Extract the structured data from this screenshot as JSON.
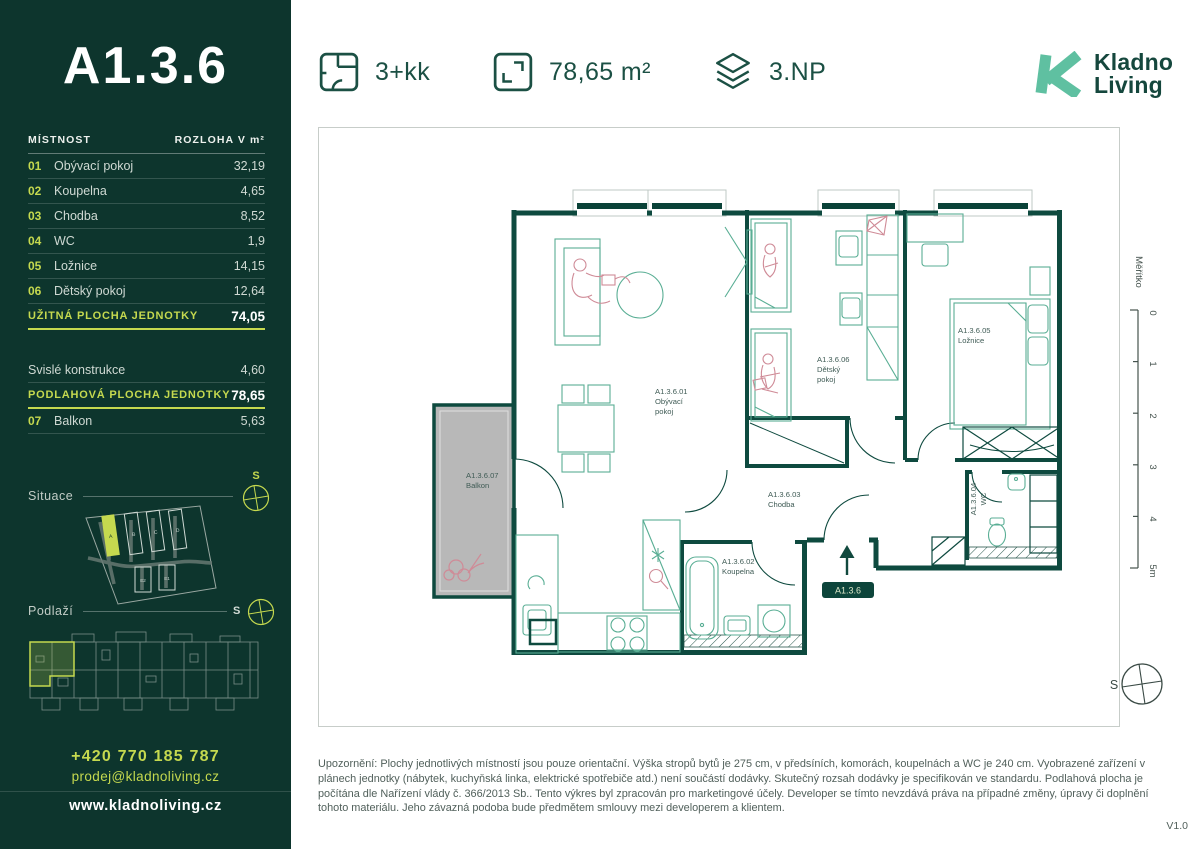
{
  "header": {
    "stats": [
      {
        "icon": "floorplan-icon",
        "value": "3+kk"
      },
      {
        "icon": "area-icon",
        "value": "78,65 m²"
      },
      {
        "icon": "floor-icon",
        "value": "3.NP"
      }
    ],
    "logo": {
      "line1": "Kladno",
      "line2": "Living"
    }
  },
  "sidebar": {
    "unit_title": "A1.3.6",
    "table_header": {
      "room": "MÍSTNOST",
      "area": "ROZLOHA V m²"
    },
    "rooms": [
      {
        "num": "01",
        "name": "Obývací pokoj",
        "area": "32,19"
      },
      {
        "num": "02",
        "name": "Koupelna",
        "area": "4,65"
      },
      {
        "num": "03",
        "name": "Chodba",
        "area": "8,52"
      },
      {
        "num": "04",
        "name": "WC",
        "area": "1,9"
      },
      {
        "num": "05",
        "name": "Ložnice",
        "area": "14,15"
      },
      {
        "num": "06",
        "name": "Dětský pokoj",
        "area": "12,64"
      }
    ],
    "usable": {
      "label": "UŽITNÁ PLOCHA JEDNOTKY",
      "value": "74,05"
    },
    "vertical": {
      "name": "Svislé konstrukce",
      "area": "4,60"
    },
    "floor_total": {
      "label": "PODLAHOVÁ PLOCHA JEDNOTKY",
      "value": "78,65"
    },
    "balcony": {
      "num": "07",
      "name": "Balkon",
      "area": "5,63"
    },
    "situace": {
      "label": "Situace",
      "compass": "S",
      "buildings": [
        "A",
        "B",
        "C",
        "D",
        "E2",
        "E1"
      ],
      "highlighted": "A"
    },
    "podlazi": {
      "label": "Podlaží",
      "compass": "S"
    },
    "contact": {
      "phone": "+420 770 185 787",
      "email": "prodej@kladnoliving.cz",
      "web": "www.kladnoliving.cz"
    }
  },
  "plan": {
    "labels": {
      "living": {
        "code": "A1.3.6.01",
        "l1": "Obývací",
        "l2": "pokoj"
      },
      "kids": {
        "code": "A1.3.6.06",
        "l1": "Dětský",
        "l2": "pokoj"
      },
      "bedroom": {
        "code": "A1.3.6.05",
        "l1": "Ložnice"
      },
      "hall": {
        "code": "A1.3.6.03",
        "l1": "Chodba"
      },
      "bath": {
        "code": "A1.3.6.02",
        "l1": "Koupelna"
      },
      "wc": {
        "code": "A1.3.6.04",
        "l1": "WC"
      },
      "balcony": {
        "code": "A1.3.6.07",
        "l1": "Balkon"
      }
    },
    "entrance_badge": "A1.3.6",
    "scale": {
      "label": "Měřítko",
      "ticks": [
        "0",
        "1",
        "2",
        "3",
        "4",
        "5m"
      ]
    },
    "compass": "S"
  },
  "footer": {
    "disclaimer": "Upozornění: Plochy jednotlivých místností jsou pouze orientační. Výška stropů bytů je 275 cm, v předsíních, komorách, koupelnách a WC je 240 cm. Vyobrazené zařízení v plánech jednotky (nábytek, kuchyňská linka, elektrické spotřebiče atd.) není součástí dodávky. Skutečný rozsah dodávky je specifikován ve standardu. Podlahová plocha je počítána dle Nařízení vlády č. 366/2013 Sb.. Tento výkres byl zpracován pro marketingové účely. Developer se tímto nevzdává práva na případné změny, úpravy či doplnění tohoto materiálu. Jeho závazná podoba bude předmětem smlouvy mezi developerem a klientem.",
    "version": "V1.0"
  },
  "colors": {
    "sidebar_bg": "#0D352D",
    "accent": "#C5D94F",
    "wall": "#0E4A3F",
    "furniture": "#59AE94",
    "pink": "#CF8B97",
    "logo_teal": "#5FC0A1",
    "header_green": "#1B5044"
  }
}
